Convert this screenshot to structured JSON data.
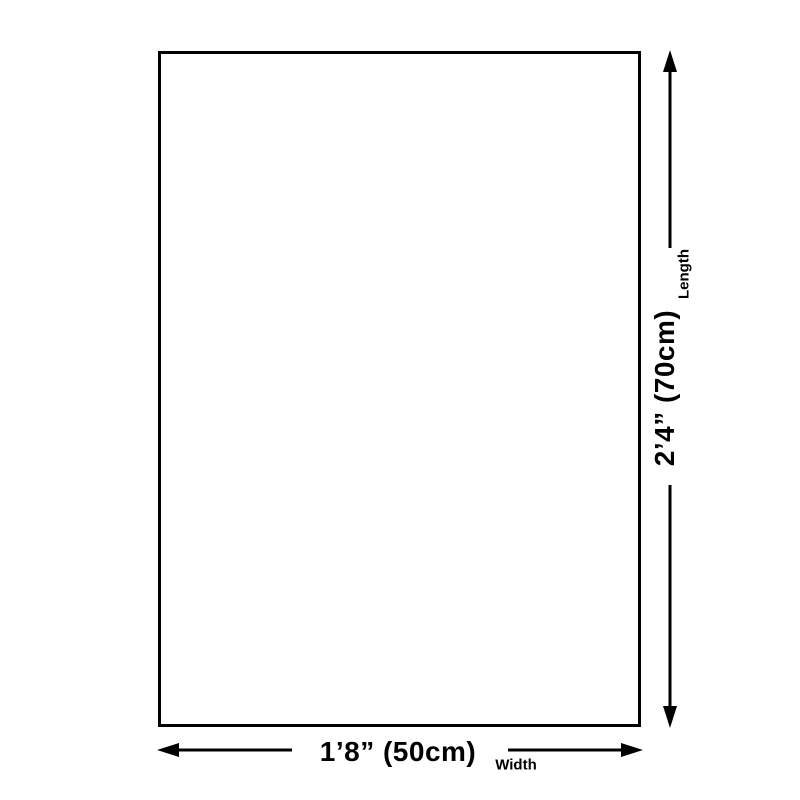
{
  "diagram": {
    "type": "product-dimension-diagram",
    "background_color": "#ffffff",
    "stroke_color": "#000000",
    "dimensions": {
      "width": {
        "value": "1’8” (50cm)",
        "label": "Width"
      },
      "length": {
        "value": "2’4” (70cm)",
        "label": "Length"
      }
    }
  }
}
